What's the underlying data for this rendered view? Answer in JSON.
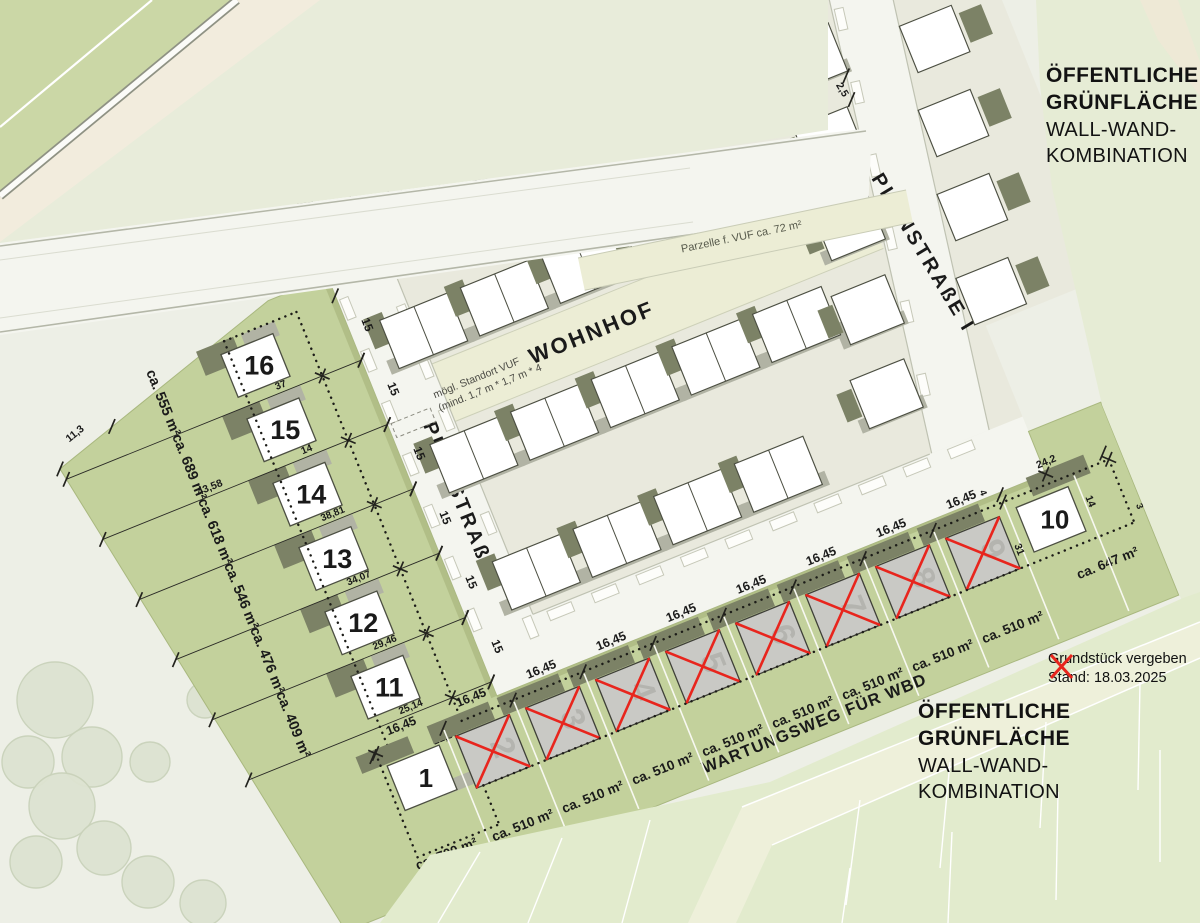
{
  "colors": {
    "bg": "#edefe6",
    "field_green": "#cbd7a6",
    "plot_green": "#c3d19c",
    "green_edge": "#a9b87f",
    "street": "#f4f5ef",
    "street_edge": "#bfc2b2",
    "band": "#ecedd5",
    "block": "#e9e9dd",
    "house_outline": "#4c4f42",
    "garage": "#7c8266",
    "shadow": "#b1b3a4",
    "sold_fill": "#c9c9c5",
    "sold_number": "#b4b4af",
    "sold_red": "#e8251d",
    "text": "#1a1a1a",
    "dim": "#2a2a26",
    "beige": "#f2ecdd",
    "pale_right": "#e6ecd5",
    "parcels": "#e2ebcd",
    "north_pale": "#e8ecda"
  },
  "streets": {
    "wohnhof": "WOHNHOF",
    "planstrasse": "PLANSTRAßE I",
    "wartungsweg": "WARTUNGSWEG FÜR WBD"
  },
  "notes": {
    "parzelle": "Parzelle f. VUF ca. 72 m²",
    "standort_line1": "mögl. Standort VUF",
    "standort_line2": "(mind. 1,7 m * 1,7 m * 4"
  },
  "blocks": {
    "top_right": [
      "ÖFFENTLICHE",
      "GRÜNFLÄCHE",
      "WALL-WAND-",
      "KOMBINATION"
    ],
    "bottom_right": [
      "ÖFFENTLICHE",
      "GRÜNFLÄCHE",
      "WALL-WAND-",
      "KOMBINATION"
    ]
  },
  "legend": {
    "sold_label": "Grundstück vergeben",
    "status_date": "Stand: 18.03.2025"
  },
  "column_plots": [
    {
      "number": "16",
      "area": "ca. 555 m²",
      "front_width": "15",
      "boundary": "37"
    },
    {
      "number": "15",
      "area": "ca. 689 m²",
      "front_width": "15",
      "boundary": "14",
      "depth": "43,58"
    },
    {
      "number": "14",
      "area": "ca. 618 m²",
      "front_width": "15",
      "boundary": "38,81"
    },
    {
      "number": "13",
      "area": "ca. 546 m²",
      "front_width": "15",
      "boundary": "34,07"
    },
    {
      "number": "12",
      "area": "ca. 476 m²",
      "front_width": "15",
      "boundary": "29,46"
    },
    {
      "number": "11",
      "area": "ca. 409 m²",
      "front_width": "15",
      "boundary": "25,14"
    }
  ],
  "row_plots": [
    {
      "number": "1",
      "area": "ca. 700 m²",
      "front_width": "16,45",
      "sold": false
    },
    {
      "number": "2",
      "area": "ca. 510 m²",
      "front_width": "16,45",
      "sold": true
    },
    {
      "number": "3",
      "area": "ca. 510 m²",
      "front_width": "16,45",
      "sold": true
    },
    {
      "number": "4",
      "area": "ca. 510 m²",
      "front_width": "16,45",
      "sold": true
    },
    {
      "number": "5",
      "area": "ca. 510 m²",
      "front_width": "16,45",
      "sold": true
    },
    {
      "number": "6",
      "area": "ca. 510 m²",
      "front_width": "16,45",
      "sold": true
    },
    {
      "number": "7",
      "area": "ca. 510 m²",
      "front_width": "16,45",
      "sold": true
    },
    {
      "number": "8",
      "area": "ca. 510 m²",
      "front_width": "16,45",
      "sold": true
    },
    {
      "number": "9",
      "area": "ca. 510 m²",
      "front_width": "16,45",
      "sold": true
    },
    {
      "number": "10",
      "area": "ca. 647 m²",
      "sold": false,
      "top_width": "24,2",
      "left_depth": "31",
      "right_width": "14"
    }
  ],
  "measurements": {
    "rear_edge": "11,3",
    "corner_segment": "21,87",
    "corner_front": "15",
    "street_width": "2,5",
    "plot10_edge": "3",
    "plot10_street": "4"
  }
}
